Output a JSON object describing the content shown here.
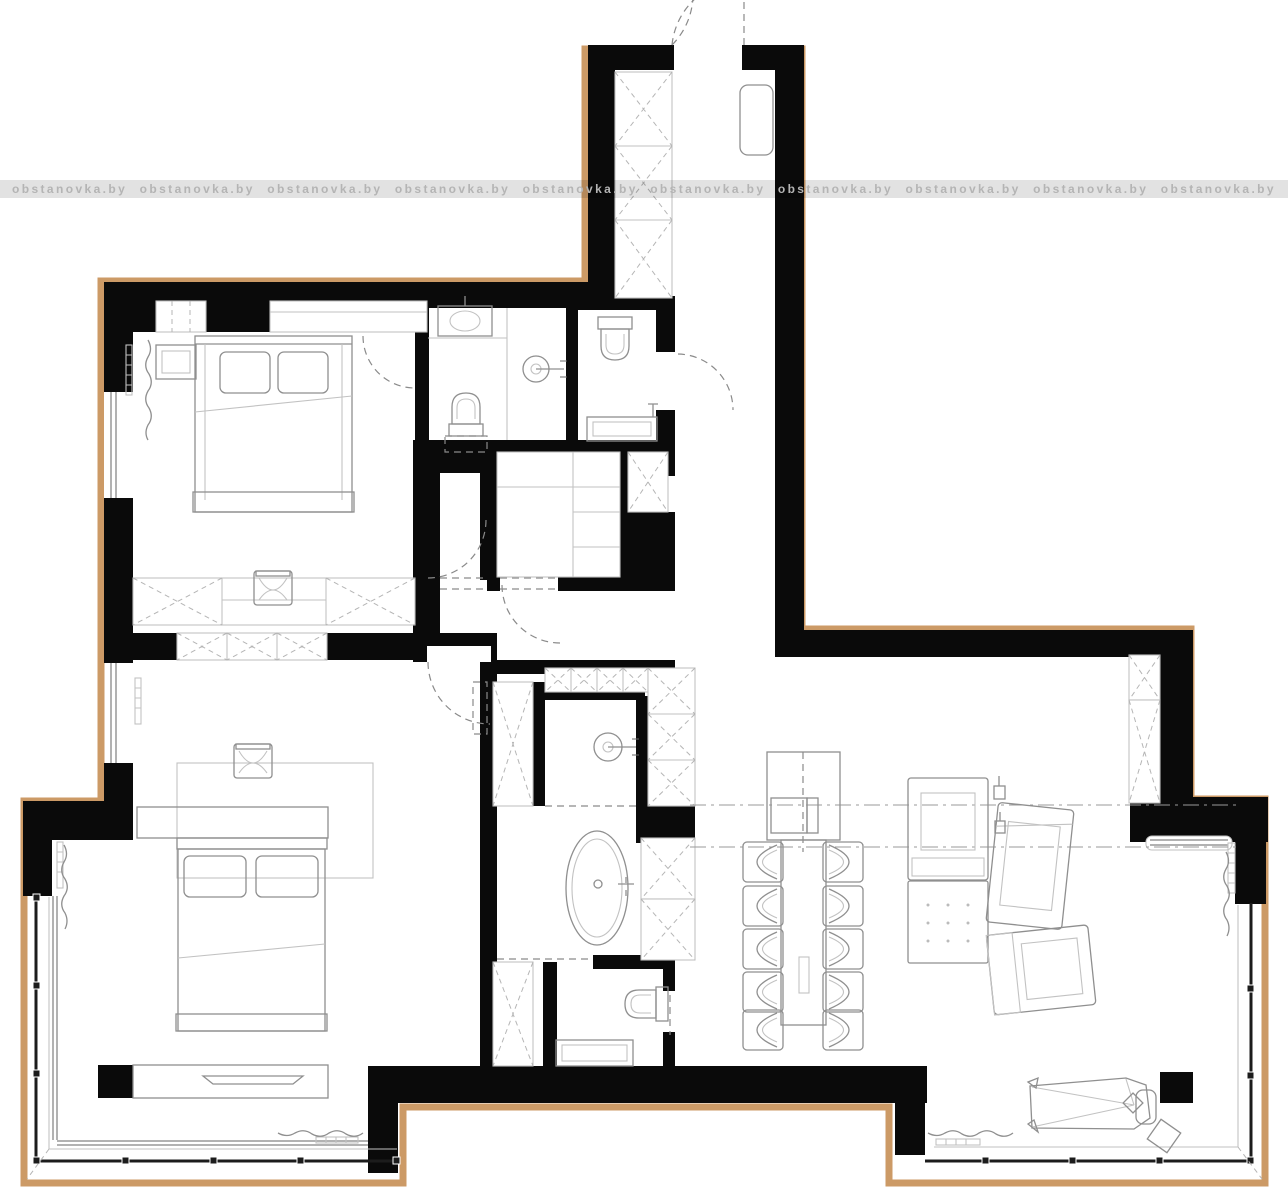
{
  "watermark": {
    "text": "obstanovka.by"
  },
  "colors": {
    "wall": "#0a0a0a",
    "boundary": "#cc9a66",
    "paper": "#ffffff",
    "furniture_line": "#8f8f8f",
    "light_line": "#c2c2c2",
    "dash_line": "#8a8a8a",
    "watermark_text_color": "#b4b4b4"
  },
  "plan": {
    "kind": "apartment floor plan drawing",
    "features": {
      "beds": 2,
      "bathtubs": 1,
      "toilets": 3,
      "washbasins": 2,
      "shower_heads": 2,
      "dining_chairs": 10,
      "lounge_chairs": 3,
      "ottomans": 1,
      "chaise_longues": 1,
      "balconies": 2,
      "x_marked_wardrobes": 9
    }
  }
}
